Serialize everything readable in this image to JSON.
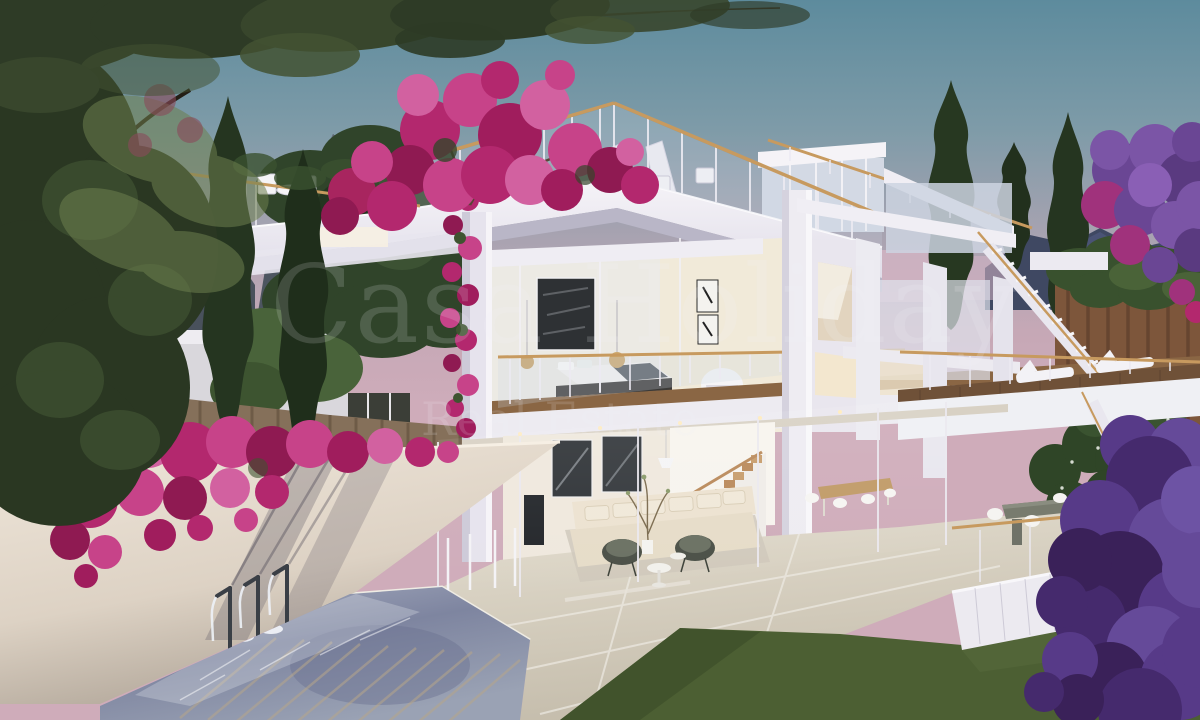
{
  "watermark": {
    "line1": "Casa Holiday",
    "line2": "Real Estate"
  },
  "scene": {
    "type": "architectural_render",
    "time_of_day": "dusk",
    "description": "Modern white multi-level villa render at dusk: rooftop terrace with glass railing, open bedroom level, glazed living room, outdoor dining terrace, bridge walkway with sun loungers, exterior staircase, water-feature pool with three spouts under a bougainvillea-covered wall, lawn, cypress trees and a mountain backdrop",
    "elements": [
      "dusk-sky",
      "mountains",
      "olive-canopy",
      "cypress-trees",
      "bougainvillea",
      "white-villa",
      "roof-terrace",
      "penthouse",
      "bedroom-level",
      "living-room",
      "dining-terrace",
      "exterior-staircase",
      "bridge-walkway",
      "green-wall",
      "wooden-fence",
      "garden-wall",
      "fountain-spouts",
      "pool",
      "tiled-deck",
      "lawn",
      "purple-tree"
    ]
  },
  "palette": {
    "sky_top": "#5d8b9d",
    "sky_horizon": "#d4afbd",
    "structure_white": "#f2f0f5",
    "structure_shadow": "#c9c6d6",
    "bougainvillea_magenta": "#b3286e",
    "bougainvillea_purple": "#5a3a8a",
    "cypress_green": "#273621",
    "lawn_green": "#4f6234",
    "pool_water": "#8d93ab",
    "wood_rail": "#c79a5f",
    "wall_warm": "#e7ddd0"
  }
}
